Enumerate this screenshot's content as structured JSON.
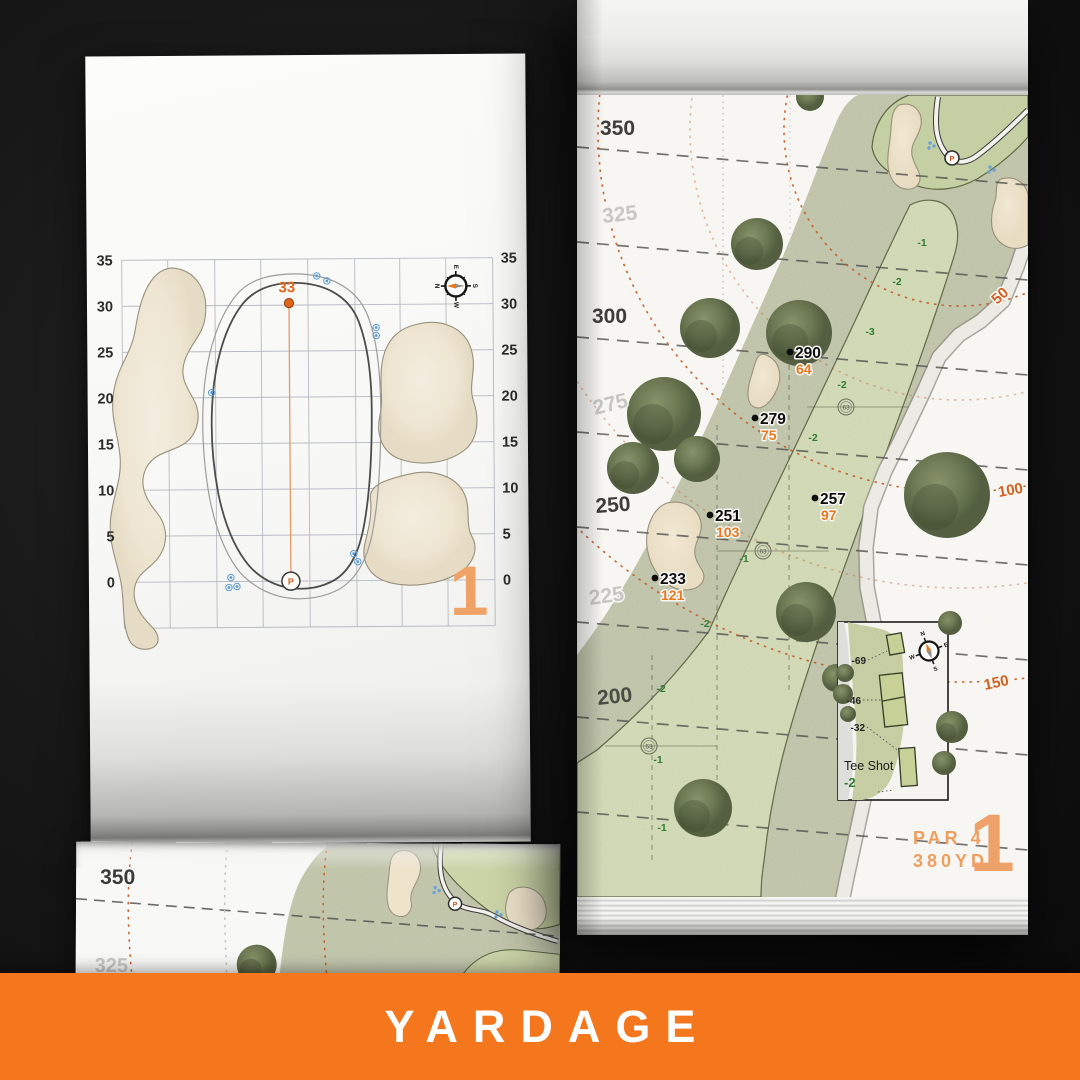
{
  "colors": {
    "accent_orange": "#f5771d",
    "salmon_orange": "#efa267",
    "carry_orange": "#e8791e",
    "elevation_green": "#2f7d32",
    "sprinkler_blue": "#5b9bd5",
    "arc_orange": "#c65f28"
  },
  "banner": {
    "label": "YARDAGE"
  },
  "left_page": {
    "hole_number": "1",
    "green_depth_label": "33",
    "pin_marker": "P",
    "axis_labels": [
      "35",
      "30",
      "25",
      "20",
      "15",
      "10",
      "5",
      "0"
    ],
    "compass": {
      "n": "N",
      "e": "E",
      "s": "S",
      "w": "W"
    }
  },
  "right_page": {
    "hole_number": "1",
    "par_label": "PAR 4",
    "yardage_label": "380YD",
    "pin_marker": "P",
    "distance_ticks": [
      "350",
      "325",
      "300",
      "275",
      "250",
      "225",
      "200"
    ],
    "carry_arc_labels": [
      "50",
      "100",
      "150"
    ],
    "yardage_points": [
      {
        "from_tee": "290",
        "to_green": "64"
      },
      {
        "from_tee": "279",
        "to_green": "75"
      },
      {
        "from_tee": "257",
        "to_green": "97"
      },
      {
        "from_tee": "251",
        "to_green": "103"
      },
      {
        "from_tee": "233",
        "to_green": "121"
      }
    ],
    "elevation_marks": [
      "-1",
      "-2",
      "-3",
      "-2",
      "-2",
      "-1",
      "-2",
      "-2",
      "-1",
      "-1"
    ],
    "sprinkler_heads": [
      "63",
      "63",
      "63"
    ],
    "tee_inset": {
      "title": "Tee Shot",
      "elevation": "-2",
      "tee_distances": [
        "-69",
        "-46",
        "-32"
      ],
      "compass": {
        "n": "N",
        "e": "E",
        "s": "S",
        "w": "W"
      }
    }
  },
  "folded_page": {
    "distance_ticks": [
      "350",
      "325"
    ]
  }
}
